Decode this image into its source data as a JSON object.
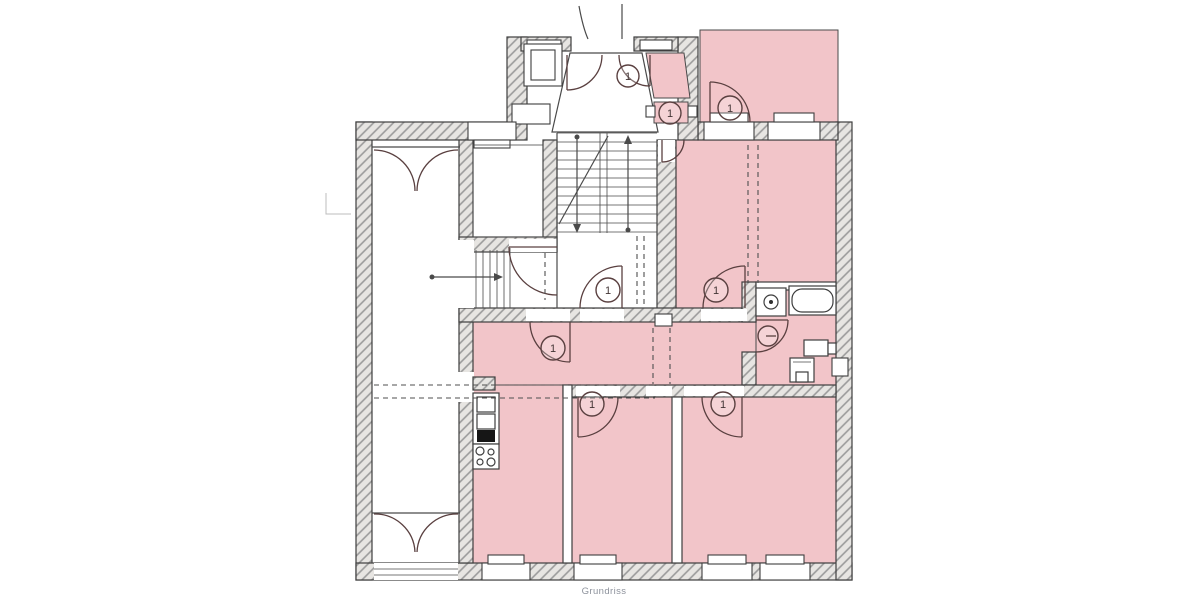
{
  "title": {
    "text": "Grundriss"
  },
  "labels": {
    "door": "1"
  },
  "colors": {
    "bg": "#ffffff",
    "pink": "#f2c5c9",
    "wall": "#e7e5e2",
    "hatch": "#9a9a9a",
    "stroke": "#3e3e3e",
    "line": "#4a4a4a",
    "arc": "#5a4040",
    "dash": "#4f4f4f",
    "dark": "#161616",
    "caption": "#8d929c"
  }
}
